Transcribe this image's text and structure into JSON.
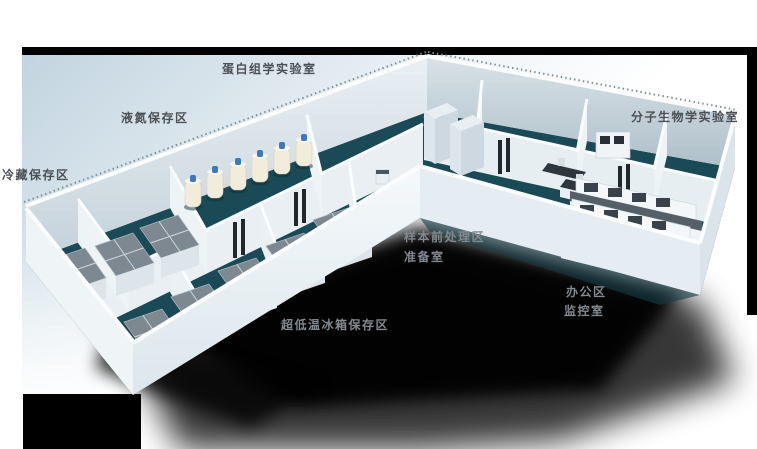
{
  "illustration": {
    "type": "3d-laboratory-floorplan",
    "labels": [
      {
        "id": "proteomics-lab",
        "text": "蛋白组学实验室",
        "x": 222,
        "y": 62,
        "tone": "dark"
      },
      {
        "id": "ln2-storage-area",
        "text": "液氮保存区",
        "x": 121,
        "y": 111,
        "tone": "dark"
      },
      {
        "id": "cold-storage-area",
        "text": "冷藏保存区",
        "x": 2,
        "y": 168,
        "tone": "dark"
      },
      {
        "id": "molecular-biology-lab",
        "text": "分子生物学实验室",
        "x": 631,
        "y": 110,
        "tone": "dark"
      },
      {
        "id": "sample-pretreatment-area",
        "text": "样本前处理区",
        "x": 404,
        "y": 230,
        "tone": "light"
      },
      {
        "id": "prep-room",
        "text": "准备室",
        "x": 404,
        "y": 250,
        "tone": "light"
      },
      {
        "id": "ulf-freezer-storage-area",
        "text": "超低温冰箱保存区",
        "x": 281,
        "y": 318,
        "tone": "light"
      },
      {
        "id": "office-area",
        "text": "办公区",
        "x": 566,
        "y": 285,
        "tone": "light"
      },
      {
        "id": "monitoring-room",
        "text": "监控室",
        "x": 564,
        "y": 304,
        "tone": "light"
      }
    ],
    "colors": {
      "backdrop": "#c2d4e0",
      "floor": "#1a4a55",
      "floorDark": "#123a44",
      "wallFace": "#edf2f5",
      "wallShade": "#b9c7d0",
      "wallRim": "#fafcfd",
      "freezerTop": "#7d8890",
      "freezerBody": "#dde5ea",
      "benchTop": "#555f67",
      "cabinetDark": "#39424a",
      "tankBody": "#f2edda",
      "tankCap": "#3b7ac2",
      "labelDark": "#4b5055",
      "labelLight": "#83898e",
      "shadow": "#000000"
    }
  }
}
